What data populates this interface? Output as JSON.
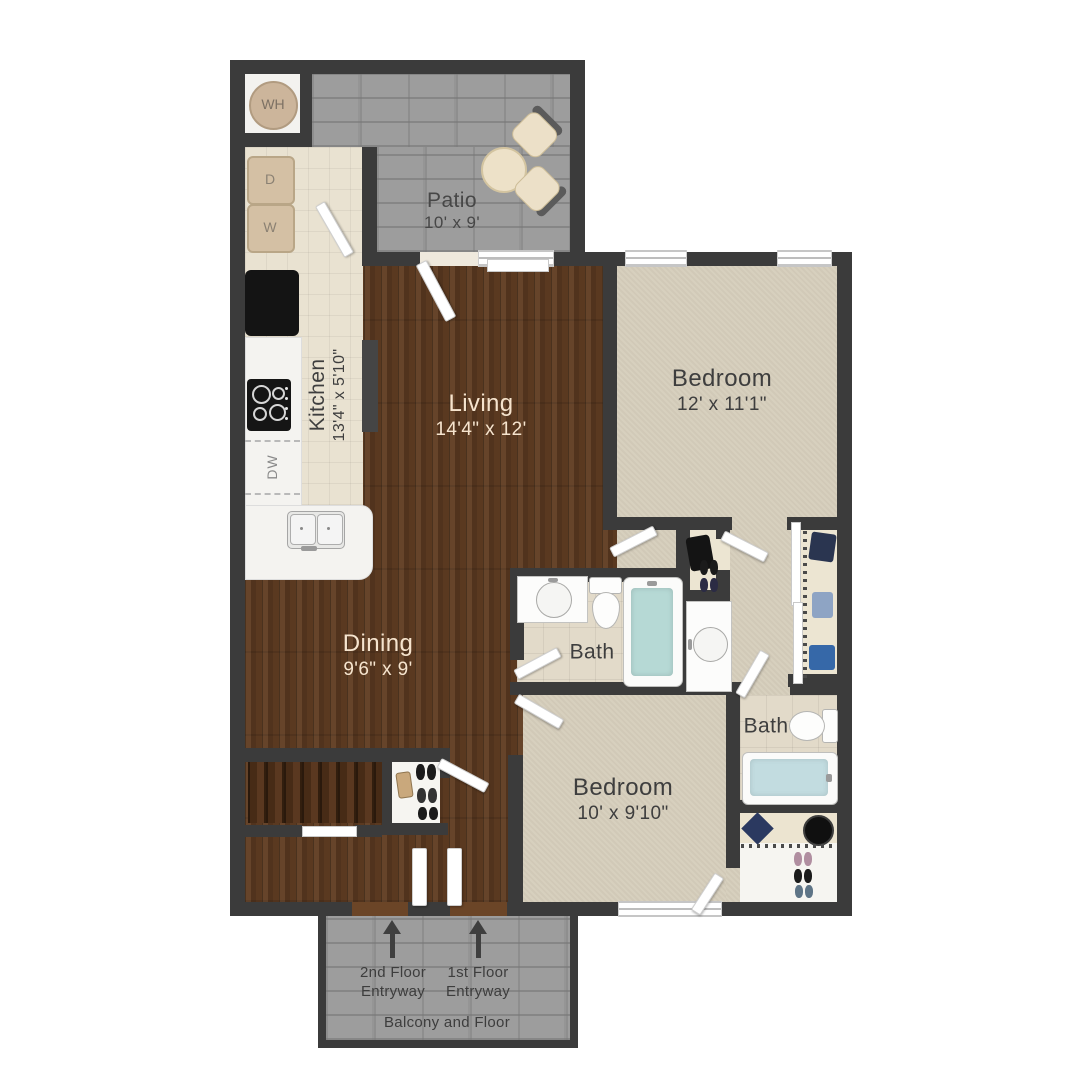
{
  "rooms": {
    "patio": {
      "name": "Patio",
      "dims": "10' x 9'"
    },
    "kitchen": {
      "name": "Kitchen",
      "dims": "13'4\" x 5'10\""
    },
    "living": {
      "name": "Living",
      "dims": "14'4\" x 12'"
    },
    "dining": {
      "name": "Dining",
      "dims": "9'6\" x 9'"
    },
    "bedroom_top": {
      "name": "Bedroom",
      "dims": "12' x 11'1\""
    },
    "bedroom_bottom": {
      "name": "Bedroom",
      "dims": "10' x 9'10\""
    },
    "bath_main": {
      "name": "Bath"
    },
    "bath_second": {
      "name": "Bath"
    }
  },
  "fixtures": {
    "water_heater": "WH",
    "dryer": "D",
    "washer": "W",
    "dishwasher": "DW"
  },
  "entry": {
    "second_floor": {
      "line1": "2nd Floor",
      "line2": "Entryway"
    },
    "first_floor": {
      "line1": "1st Floor",
      "line2": "Entryway"
    },
    "balcony_note": "Balcony and Floor"
  },
  "colors": {
    "wall": "#3b3b3b",
    "wood_floor": "#5a3920",
    "carpet": "#d5cdbb",
    "kitchen_tile": "#e9e2d1",
    "patio_concrete": "#9d9d9d",
    "tub_water": "#b6d9d5",
    "label_dark": "#3e3e3e",
    "label_light": "#f6e4ce"
  }
}
